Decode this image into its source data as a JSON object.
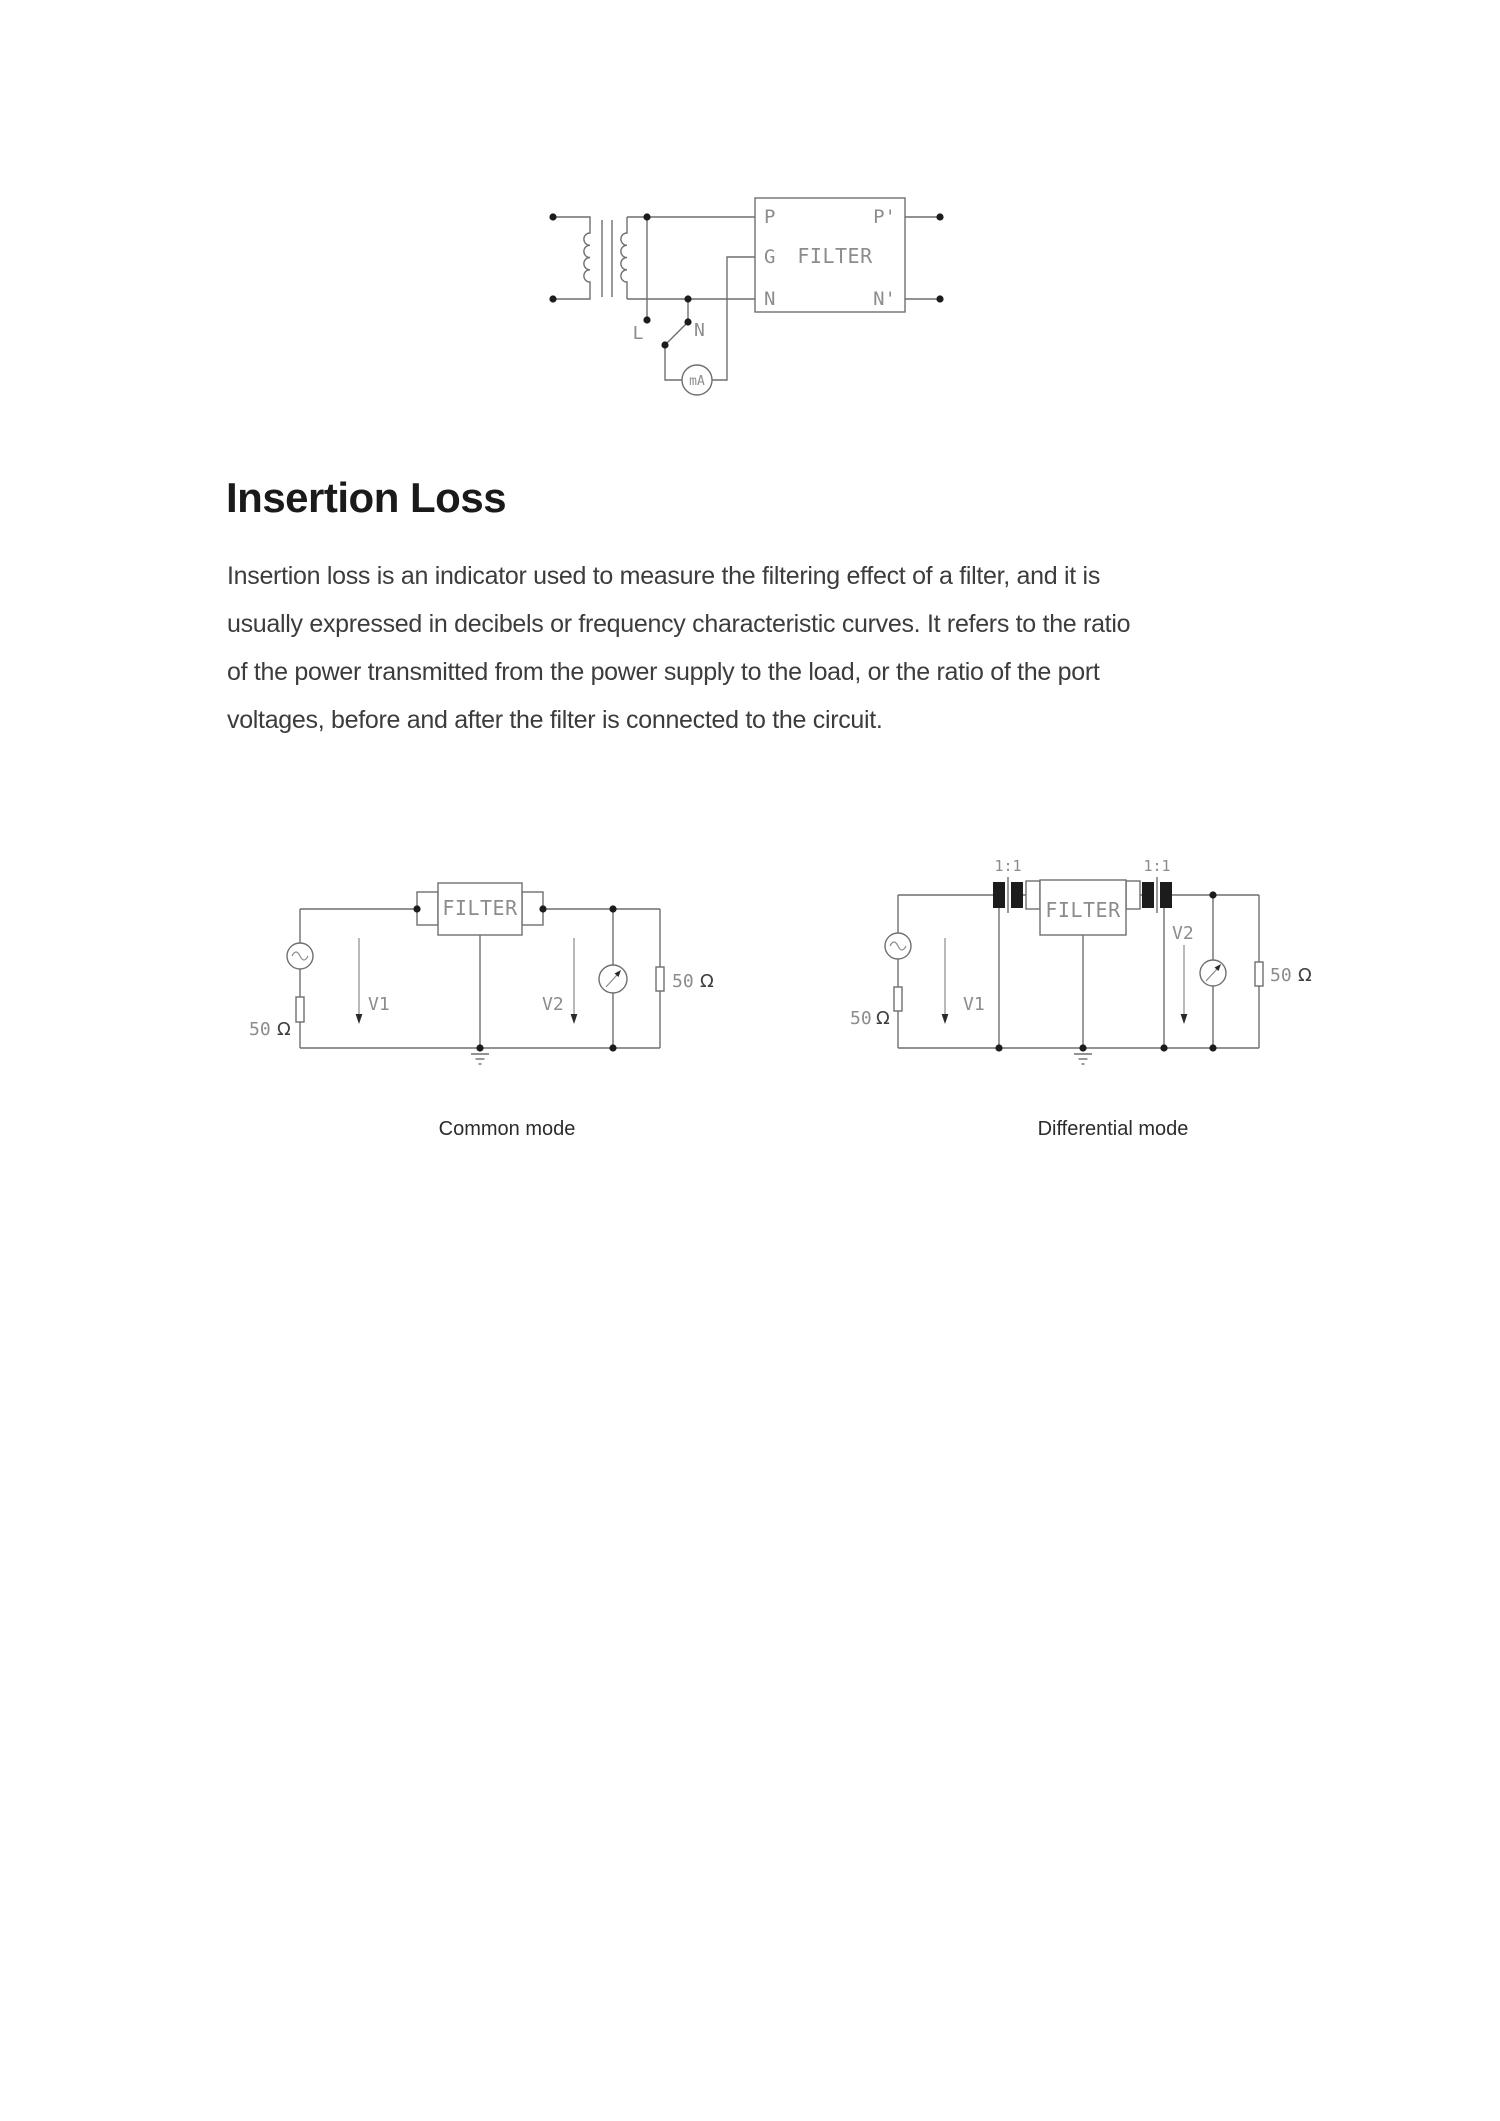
{
  "heading": {
    "text": "Insertion Loss"
  },
  "paragraph": {
    "lines": [
      "Insertion loss is an indicator used to measure the filtering effect of a filter, and it is",
      "usually expressed in decibels or frequency characteristic curves. It refers to the ratio",
      "of the power transmitted from the power supply to the load, or the ratio of the port",
      "voltages, before and after the filter is connected to the circuit."
    ]
  },
  "top_diagram": {
    "description": "filter leakage-current test circuit with isolation transformer",
    "filter_label": "FILTER",
    "ports": {
      "p": "P",
      "g": "G",
      "n": "N",
      "p_out": "P'",
      "n_out": "N'"
    },
    "line_terminal_label": "L",
    "neutral_terminal_label": "N",
    "meter_label": "mA"
  },
  "common_mode": {
    "filter_label": "FILTER",
    "v1_label": "V1",
    "v2_label": "V2",
    "source_resistor": {
      "value": "50",
      "unit": "Ω"
    },
    "load_resistor": {
      "value": "50",
      "unit": "Ω"
    },
    "caption": "Common mode"
  },
  "differential_mode": {
    "filter_label": "FILTER",
    "v1_label": "V1",
    "v2_label": "V2",
    "transformer_ratio_left": "1:1",
    "transformer_ratio_right": "1:1",
    "source_resistor": {
      "value": "50",
      "unit": "Ω"
    },
    "load_resistor": {
      "value": "50",
      "unit": "Ω"
    },
    "caption": "Differential mode"
  },
  "colors": {
    "page_bg": "#ffffff",
    "circuit_stroke": "#6f6f6f",
    "cad_label": "#8c8c8c",
    "ohm_symbol": "#3f3f3f",
    "junction_dot": "#1c1c1c",
    "heading_text": "#1a1a1a",
    "body_text": "#3c3c3c",
    "caption_text": "#2b2b2b"
  }
}
